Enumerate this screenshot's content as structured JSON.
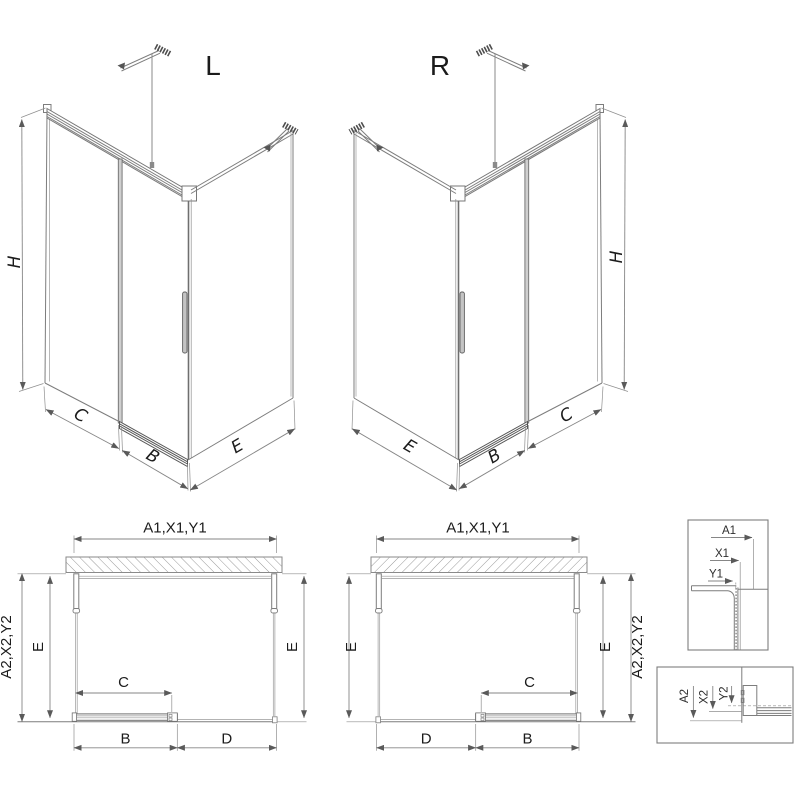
{
  "drawing": {
    "iso_left": {
      "title": "L",
      "height": "H",
      "fixed_front": "C",
      "door": "B",
      "side": "E"
    },
    "iso_right": {
      "title": "R",
      "height": "H",
      "fixed_front": "C",
      "door": "B",
      "side": "E"
    },
    "plan_left": {
      "width_total": "A1,X1,Y1",
      "depth_total": "A2,X2,Y2",
      "depth_inner_left": "E",
      "depth_inner_right": "E",
      "opening": "C",
      "door": "B",
      "fixed": "D"
    },
    "plan_right": {
      "width_total": "A1,X1,Y1",
      "depth_total": "A2,X2,Y2",
      "depth_inner_left": "E",
      "depth_inner_right": "E",
      "opening": "C",
      "door": "B",
      "fixed": "D"
    },
    "detail_wall_profile": {
      "a1": "A1",
      "x1": "X1",
      "y1": "Y1"
    },
    "detail_rail_profile": {
      "a2": "A2",
      "x2": "X2",
      "y2": "Y2"
    },
    "colors": {
      "line": "#7d7d7d",
      "dark": "#565656",
      "text": "#1b1b1b",
      "background": "#ffffff"
    }
  }
}
